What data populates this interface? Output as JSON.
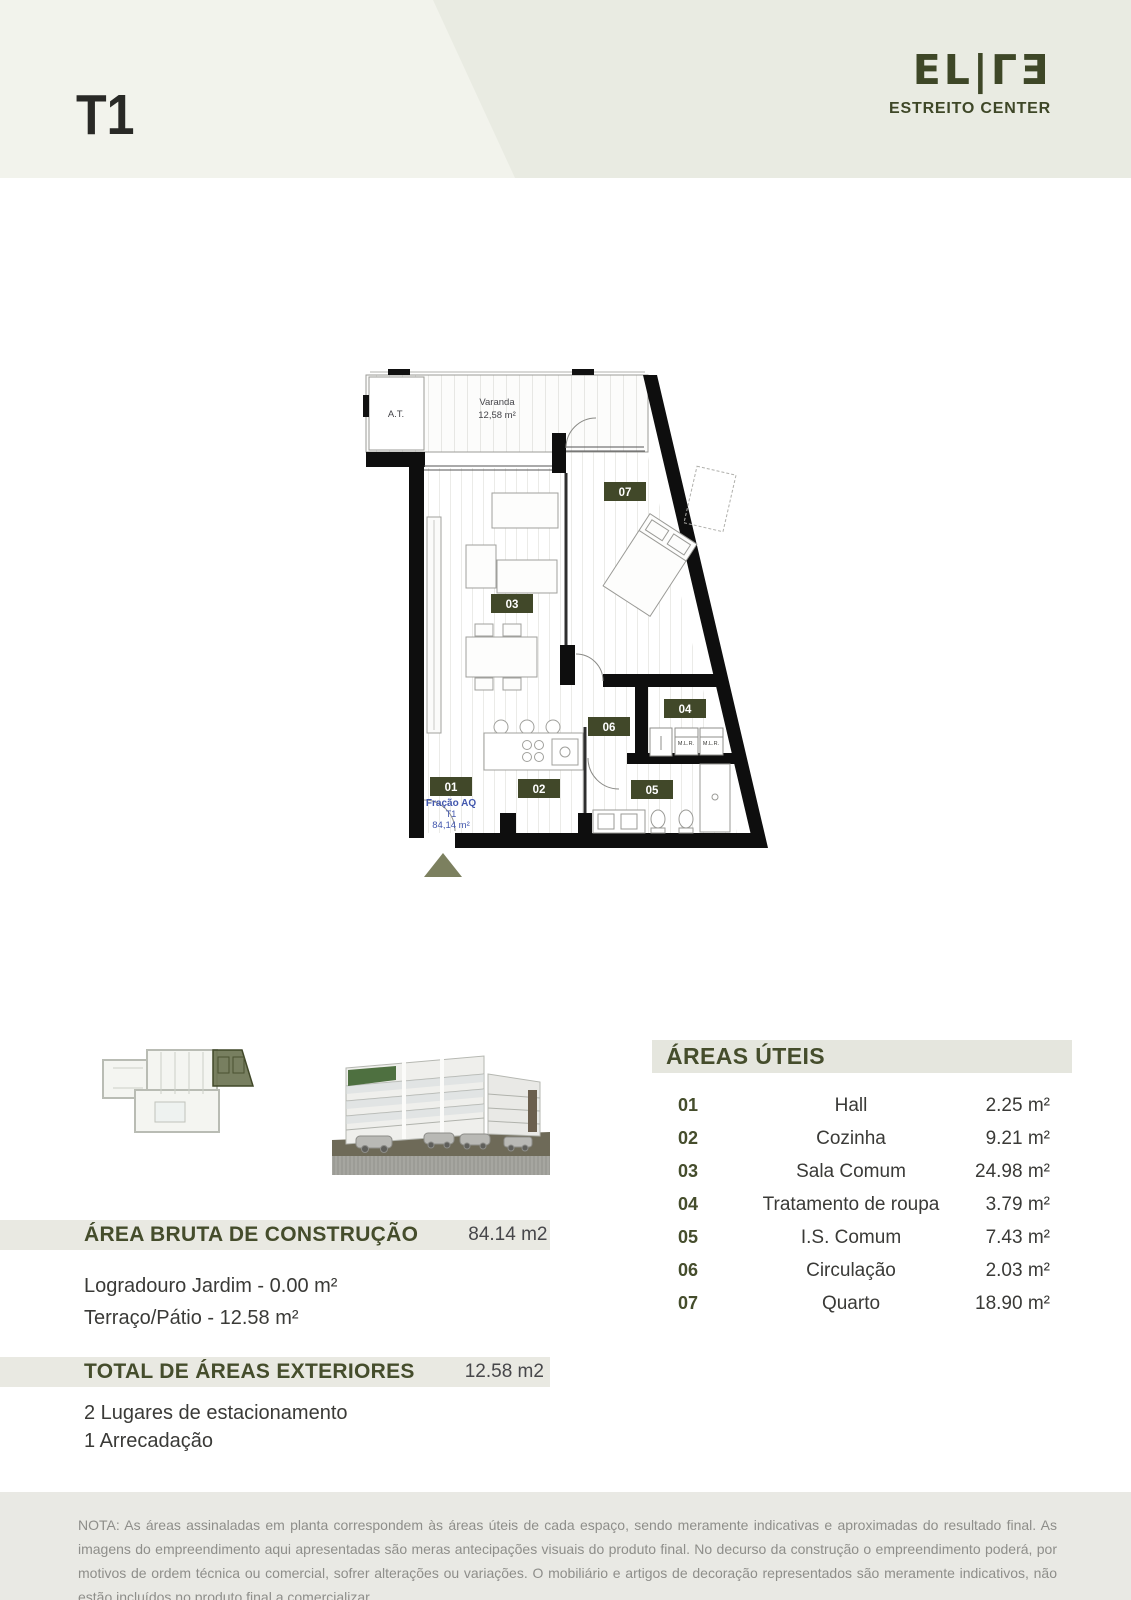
{
  "header": {
    "unit_type": "T1",
    "logo_text": "EL|ΓƎ",
    "logo_subtitle": "ESTREITO CENTER"
  },
  "plan": {
    "at_label": "A.T.",
    "varanda_label": "Varanda",
    "varanda_area": "12,58 m²",
    "mlr_label_1": "M.L.R.",
    "mlr_label_2": "M.L.R.",
    "fraction": {
      "label": "Fração AQ",
      "unit": "T1",
      "area": "84,14 m²"
    },
    "badges": [
      "01",
      "02",
      "03",
      "04",
      "05",
      "06",
      "07"
    ]
  },
  "areas": {
    "title": "ÁREAS ÚTEIS",
    "rows": [
      {
        "code": "01",
        "name": "Hall",
        "area": "2.25 m²"
      },
      {
        "code": "02",
        "name": "Cozinha",
        "area": "9.21 m²"
      },
      {
        "code": "03",
        "name": "Sala Comum",
        "area": "24.98 m²"
      },
      {
        "code": "04",
        "name": "Tratamento de roupa",
        "area": "3.79 m²"
      },
      {
        "code": "05",
        "name": "I.S. Comum",
        "area": "7.43 m²"
      },
      {
        "code": "06",
        "name": "Circulação",
        "area": "2.03 m²"
      },
      {
        "code": "07",
        "name": "Quarto",
        "area": "18.90 m²"
      }
    ]
  },
  "construction": {
    "title": "ÁREA BRUTA DE CONSTRUÇÃO",
    "value": "84.14 m2",
    "line1": "Logradouro Jardim - 0.00 m²",
    "line2": "Terraço/Pátio - 12.58 m²"
  },
  "exteriors": {
    "title": "TOTAL DE ÁREAS EXTERIORES",
    "value": "12.58 m2",
    "line1": "2 Lugares de estacionamento",
    "line2": "1 Arrecadação"
  },
  "note": "NOTA: As áreas assinaladas em planta correspondem às áreas úteis de cada espaço, sendo meramente indicativas e aproximadas do resultado final. As imagens do empreendimento aqui apresentadas são meras antecipações visuais do produto final. No decurso da construção o empreendimento poderá, por motivos de ordem técnica ou comercial, sofrer alterações ou variações. O mobiliário e artigos de decoração representados são meramente indicativos, não estão incluídos no produto final a comercializar.",
  "colors": {
    "accent_green": "#454d2c",
    "badge_green": "#414829",
    "band_gray": "#e9e9e2",
    "header_left": "#f2f3ec",
    "header_right": "#e9ebe2",
    "fraction_blue": "#4257ae",
    "triangle_olive": "#7c805f"
  }
}
